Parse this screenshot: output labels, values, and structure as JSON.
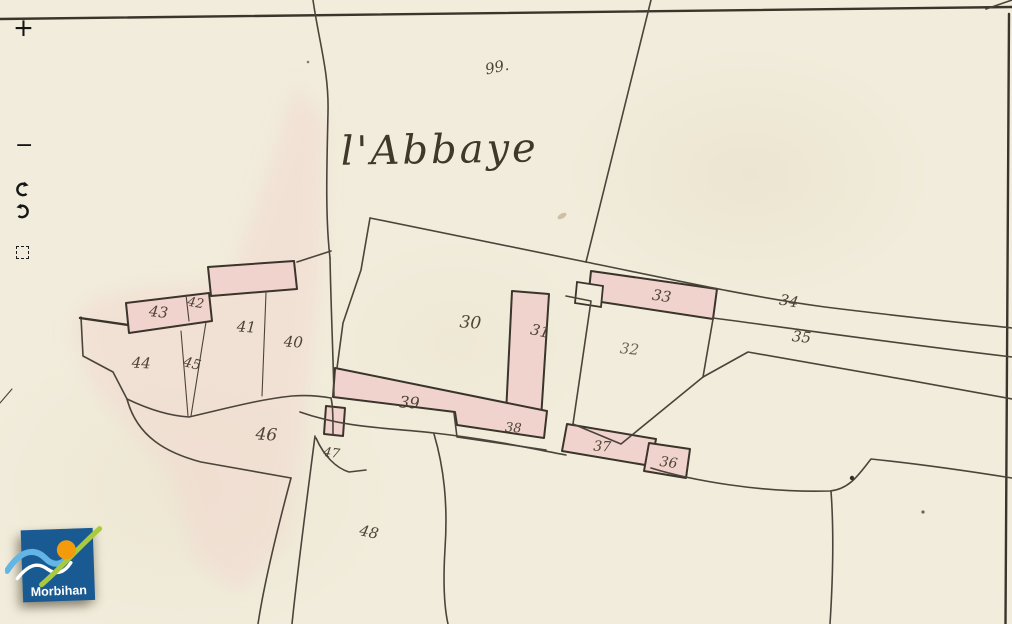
{
  "viewer": {
    "paper_color": "#f1ecdb",
    "line_color": "#4b443a",
    "line_strong_color": "#3a342b",
    "building_fill_color": "#f0d3cc",
    "wash_color": "#f2d9d0",
    "ink_color": "#4d4434"
  },
  "toolbar": {
    "items": [
      {
        "name": "zoom-in",
        "glyph": "+"
      },
      {
        "name": "zoom-out",
        "glyph": "−"
      },
      {
        "name": "rotate-clockwise",
        "glyph": "⟳"
      },
      {
        "name": "rotate-counterclockwise",
        "glyph": "⟲"
      },
      {
        "name": "select-area",
        "glyph": "⬚"
      }
    ]
  },
  "map": {
    "place_label": {
      "text": "l'Abbaye",
      "x": 440,
      "y": 163,
      "size": 40,
      "rot": -1
    },
    "parcel_labels": [
      {
        "text": "99.",
        "x": 498,
        "y": 72,
        "size": 15,
        "rot": -12
      },
      {
        "text": "30",
        "x": 470,
        "y": 328,
        "size": 17,
        "rot": 4
      },
      {
        "text": "31",
        "x": 539,
        "y": 336,
        "size": 15,
        "rot": 12
      },
      {
        "text": "32",
        "x": 629,
        "y": 354,
        "size": 15,
        "rot": 6,
        "op": 0.8
      },
      {
        "text": "33",
        "x": 661,
        "y": 301,
        "size": 15,
        "rot": 8
      },
      {
        "text": "34",
        "x": 788,
        "y": 306,
        "size": 15,
        "rot": 10
      },
      {
        "text": "35",
        "x": 801,
        "y": 342,
        "size": 15,
        "rot": 6
      },
      {
        "text": "36",
        "x": 668,
        "y": 467,
        "size": 14,
        "rot": 8
      },
      {
        "text": "37",
        "x": 602,
        "y": 451,
        "size": 14,
        "rot": 3
      },
      {
        "text": "38",
        "x": 513,
        "y": 432,
        "size": 13,
        "rot": 4
      },
      {
        "text": "39",
        "x": 409,
        "y": 408,
        "size": 16,
        "rot": 4
      },
      {
        "text": "40",
        "x": 293,
        "y": 347,
        "size": 15,
        "rot": 4
      },
      {
        "text": "41",
        "x": 246,
        "y": 332,
        "size": 15,
        "rot": 4
      },
      {
        "text": "42",
        "x": 195,
        "y": 307,
        "size": 13,
        "rot": 10
      },
      {
        "text": "43",
        "x": 158,
        "y": 317,
        "size": 15,
        "rot": 6
      },
      {
        "text": "44",
        "x": 141,
        "y": 368,
        "size": 15,
        "rot": 3
      },
      {
        "text": "45",
        "x": 191,
        "y": 368,
        "size": 14,
        "rot": 14
      },
      {
        "text": "46",
        "x": 266,
        "y": 440,
        "size": 17,
        "rot": 4
      },
      {
        "text": "47",
        "x": 331,
        "y": 457,
        "size": 13,
        "rot": 8
      },
      {
        "text": "48",
        "x": 368,
        "y": 537,
        "size": 15,
        "rot": 12
      }
    ]
  },
  "logo": {
    "text": "Morbihan",
    "bg_color": "#1a5a92",
    "wave_color": "#62b5e4",
    "sun_color": "#f49b0c",
    "leaf_color": "#a9c93e"
  }
}
